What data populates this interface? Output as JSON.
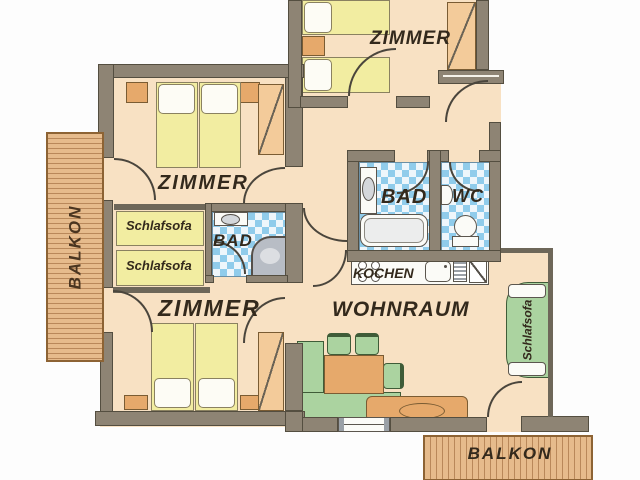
{
  "plan_type": "apartment-floor-plan",
  "labels": {
    "zimmer_top": "ZIMMER",
    "zimmer_middle": "ZIMMER",
    "zimmer_bottom": "ZIMMER",
    "bad_main": "BAD",
    "bad_small": "BAD",
    "wc": "WC",
    "kochen": "KOCHEN",
    "wohnraum": "WOHNRAUM",
    "balkon_left": "BALKON",
    "balkon_bottom": "BALKON",
    "schlafsofa_top": "Schlafsofa",
    "schlafsofa_bottom": "Schlafsofa",
    "schlafsofa_living": "Schlafsofa"
  },
  "colors": {
    "wall": "#8e8474",
    "floor": "#f8e1c3",
    "tile_blue": "#90cceb",
    "bed_yellow": "#f2eda1",
    "balcony_wood": "#e6bb8c",
    "furniture_green": "#abd3a0",
    "furniture_tan": "#e6a96b",
    "label_text": "#33291c"
  }
}
